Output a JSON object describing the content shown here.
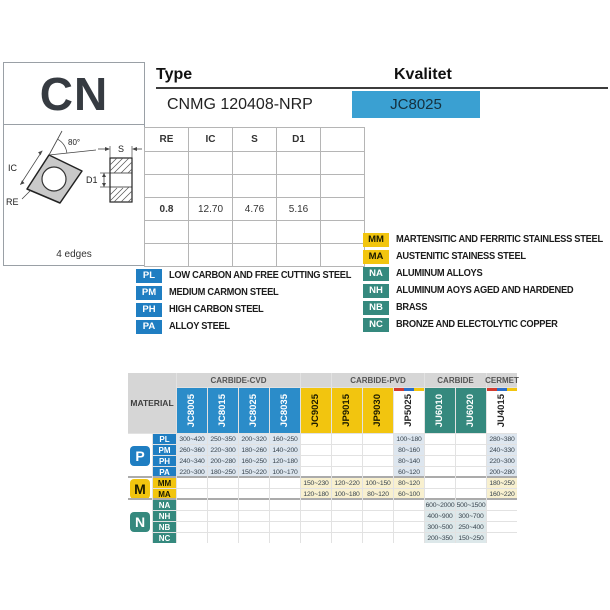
{
  "header": {
    "series": "CN",
    "type_label": "Type",
    "type_value": "CNMG 120408-NRP",
    "grade_label": "Kvalitet",
    "grade_value": "JC8025",
    "colors": {
      "grade_box": "#3aa0d2"
    }
  },
  "diagram": {
    "angle_label": "80°",
    "ic_label": "IC",
    "re_label": "RE",
    "s_label": "S",
    "d1_label": "D1",
    "edges_note": "4 edges"
  },
  "dimensions": {
    "columns": [
      "RE",
      "IC",
      "S",
      "D1",
      ""
    ],
    "rows": [
      [
        "",
        "",
        "",
        "",
        ""
      ],
      [
        "",
        "",
        "",
        "",
        ""
      ],
      [
        "0.8",
        "12.70",
        "4.76",
        "5.16",
        ""
      ],
      [
        "",
        "",
        "",
        "",
        ""
      ],
      [
        "",
        "",
        "",
        "",
        ""
      ]
    ]
  },
  "legend_left": {
    "badge_bg": "#1f7ec2",
    "badge_fg": "#ffffff",
    "items": [
      {
        "code": "PL",
        "label": "LOW CARBON AND FREE CUTTING STEEL"
      },
      {
        "code": "PM",
        "label": "MEDIUM CARMON STEEL"
      },
      {
        "code": "PH",
        "label": "HIGH CARBON STEEL"
      },
      {
        "code": "PA",
        "label": "ALLOY STEEL"
      }
    ]
  },
  "legend_right": {
    "items": [
      {
        "code": "MM",
        "label": "MARTENSITIC AND FERRITIC STAINLESS STEEL",
        "bg": "#f2c50f",
        "fg": "#1a1a00"
      },
      {
        "code": "MA",
        "label": "AUSTENITIC STAINESS STEEL",
        "bg": "#f2c50f",
        "fg": "#1a1a00"
      },
      {
        "code": "NA",
        "label": "ALUMINUM ALLOYS",
        "bg": "#35897e",
        "fg": "#ffffff"
      },
      {
        "code": "NH",
        "label": "ALUMINUM AOYS AGED AND HARDENED",
        "bg": "#35897e",
        "fg": "#ffffff"
      },
      {
        "code": "NB",
        "label": "BRASS",
        "bg": "#35897e",
        "fg": "#ffffff"
      },
      {
        "code": "NC",
        "label": "BRONZE AND ELECTOLYTIC COPPER",
        "bg": "#35897e",
        "fg": "#ffffff"
      }
    ]
  },
  "grades_table": {
    "material_label": "MATERIAL",
    "groups": [
      {
        "label": "CARBIDE-CVD",
        "span": 4
      },
      {
        "label": "",
        "span": 1
      },
      {
        "label": "CARBIDE-PVD",
        "span": 3
      },
      {
        "label": "CARBIDE",
        "span": 2
      },
      {
        "label": "CERMET",
        "span": 1
      }
    ],
    "columns": [
      {
        "name": "JC8005",
        "bg": "#2b8cc9",
        "fg": "#ffffff",
        "strip": [
          "#2b8cc9"
        ]
      },
      {
        "name": "JC8015",
        "bg": "#2b8cc9",
        "fg": "#ffffff",
        "strip": [
          "#2b8cc9"
        ]
      },
      {
        "name": "JC8025",
        "bg": "#2b8cc9",
        "fg": "#ffffff",
        "strip": [
          "#2b8cc9"
        ]
      },
      {
        "name": "JC8035",
        "bg": "#2b8cc9",
        "fg": "#ffffff",
        "strip": [
          "#2b8cc9"
        ]
      },
      {
        "name": "JC9025",
        "bg": "#f2c50f",
        "fg": "#1a1a00",
        "strip": [
          "#f2c50f"
        ]
      },
      {
        "name": "JP9015",
        "bg": "#f2c50f",
        "fg": "#1a1a00",
        "strip": [
          "#f2c50f"
        ]
      },
      {
        "name": "JP9030",
        "bg": "#f2c50f",
        "fg": "#1a1a00",
        "strip": [
          "#f2c50f"
        ]
      },
      {
        "name": "JP5025",
        "bg": "#ffffff",
        "fg": "#222222",
        "strip": [
          "#d23b2f",
          "#2b6fc9",
          "#f2c50f"
        ]
      },
      {
        "name": "JU6010",
        "bg": "#35897e",
        "fg": "#ffffff",
        "strip": [
          "#35897e"
        ]
      },
      {
        "name": "JU6020",
        "bg": "#35897e",
        "fg": "#ffffff",
        "strip": [
          "#35897e"
        ]
      },
      {
        "name": "JU4015",
        "bg": "#ffffff",
        "fg": "#222222",
        "strip": [
          "#d23b2f",
          "#2b6fc9",
          "#f2c50f"
        ]
      }
    ],
    "row_groups": [
      {
        "icon": "P",
        "icon_bg": "#1f7ec2",
        "icon_fg": "#ffffff",
        "tint": "#dde6ef",
        "rows": [
          {
            "code": "PL",
            "badge_bg": "#1f7ec2",
            "badge_fg": "#ffffff",
            "values": [
              "300~420",
              "250~350",
              "200~320",
              "160~250",
              "",
              "",
              "",
              "100~180",
              "",
              "",
              "280~380"
            ]
          },
          {
            "code": "PM",
            "badge_bg": "#1f7ec2",
            "badge_fg": "#ffffff",
            "values": [
              "260~360",
              "220~300",
              "180~260",
              "140~200",
              "",
              "",
              "",
              "80~160",
              "",
              "",
              "240~330"
            ]
          },
          {
            "code": "PH",
            "badge_bg": "#1f7ec2",
            "badge_fg": "#ffffff",
            "values": [
              "240~340",
              "200~280",
              "160~250",
              "120~180",
              "",
              "",
              "",
              "80~140",
              "",
              "",
              "220~300"
            ]
          },
          {
            "code": "PA",
            "badge_bg": "#1f7ec2",
            "badge_fg": "#ffffff",
            "values": [
              "220~300",
              "180~250",
              "150~220",
              "100~170",
              "",
              "",
              "",
              "60~120",
              "",
              "",
              "200~280"
            ]
          }
        ]
      },
      {
        "icon": "M",
        "icon_bg": "#f2c50f",
        "icon_fg": "#1a1a00",
        "tint": "#f8f0cf",
        "rows": [
          {
            "code": "MM",
            "badge_bg": "#f2c50f",
            "badge_fg": "#1a1a00",
            "values": [
              "",
              "",
              "",
              "",
              "150~230",
              "120~220",
              "100~150",
              "80~120",
              "",
              "",
              "180~250"
            ]
          },
          {
            "code": "MA",
            "badge_bg": "#f2c50f",
            "badge_fg": "#1a1a00",
            "values": [
              "",
              "",
              "",
              "",
              "120~180",
              "100~180",
              "80~120",
              "60~100",
              "",
              "",
              "160~220"
            ]
          }
        ]
      },
      {
        "icon": "N",
        "icon_bg": "#35897e",
        "icon_fg": "#ffffff",
        "tint": "#dde8ea",
        "rows": [
          {
            "code": "NA",
            "badge_bg": "#35897e",
            "badge_fg": "#ffffff",
            "values": [
              "",
              "",
              "",
              "",
              "",
              "",
              "",
              "",
              "600~2000",
              "500~1500",
              ""
            ]
          },
          {
            "code": "NH",
            "badge_bg": "#35897e",
            "badge_fg": "#ffffff",
            "values": [
              "",
              "",
              "",
              "",
              "",
              "",
              "",
              "",
              "400~900",
              "300~700",
              ""
            ]
          },
          {
            "code": "NB",
            "badge_bg": "#35897e",
            "badge_fg": "#ffffff",
            "values": [
              "",
              "",
              "",
              "",
              "",
              "",
              "",
              "",
              "300~500",
              "250~400",
              ""
            ]
          },
          {
            "code": "NC",
            "badge_bg": "#35897e",
            "badge_fg": "#ffffff",
            "values": [
              "",
              "",
              "",
              "",
              "",
              "",
              "",
              "",
              "200~350",
              "150~250",
              ""
            ]
          }
        ]
      }
    ]
  }
}
